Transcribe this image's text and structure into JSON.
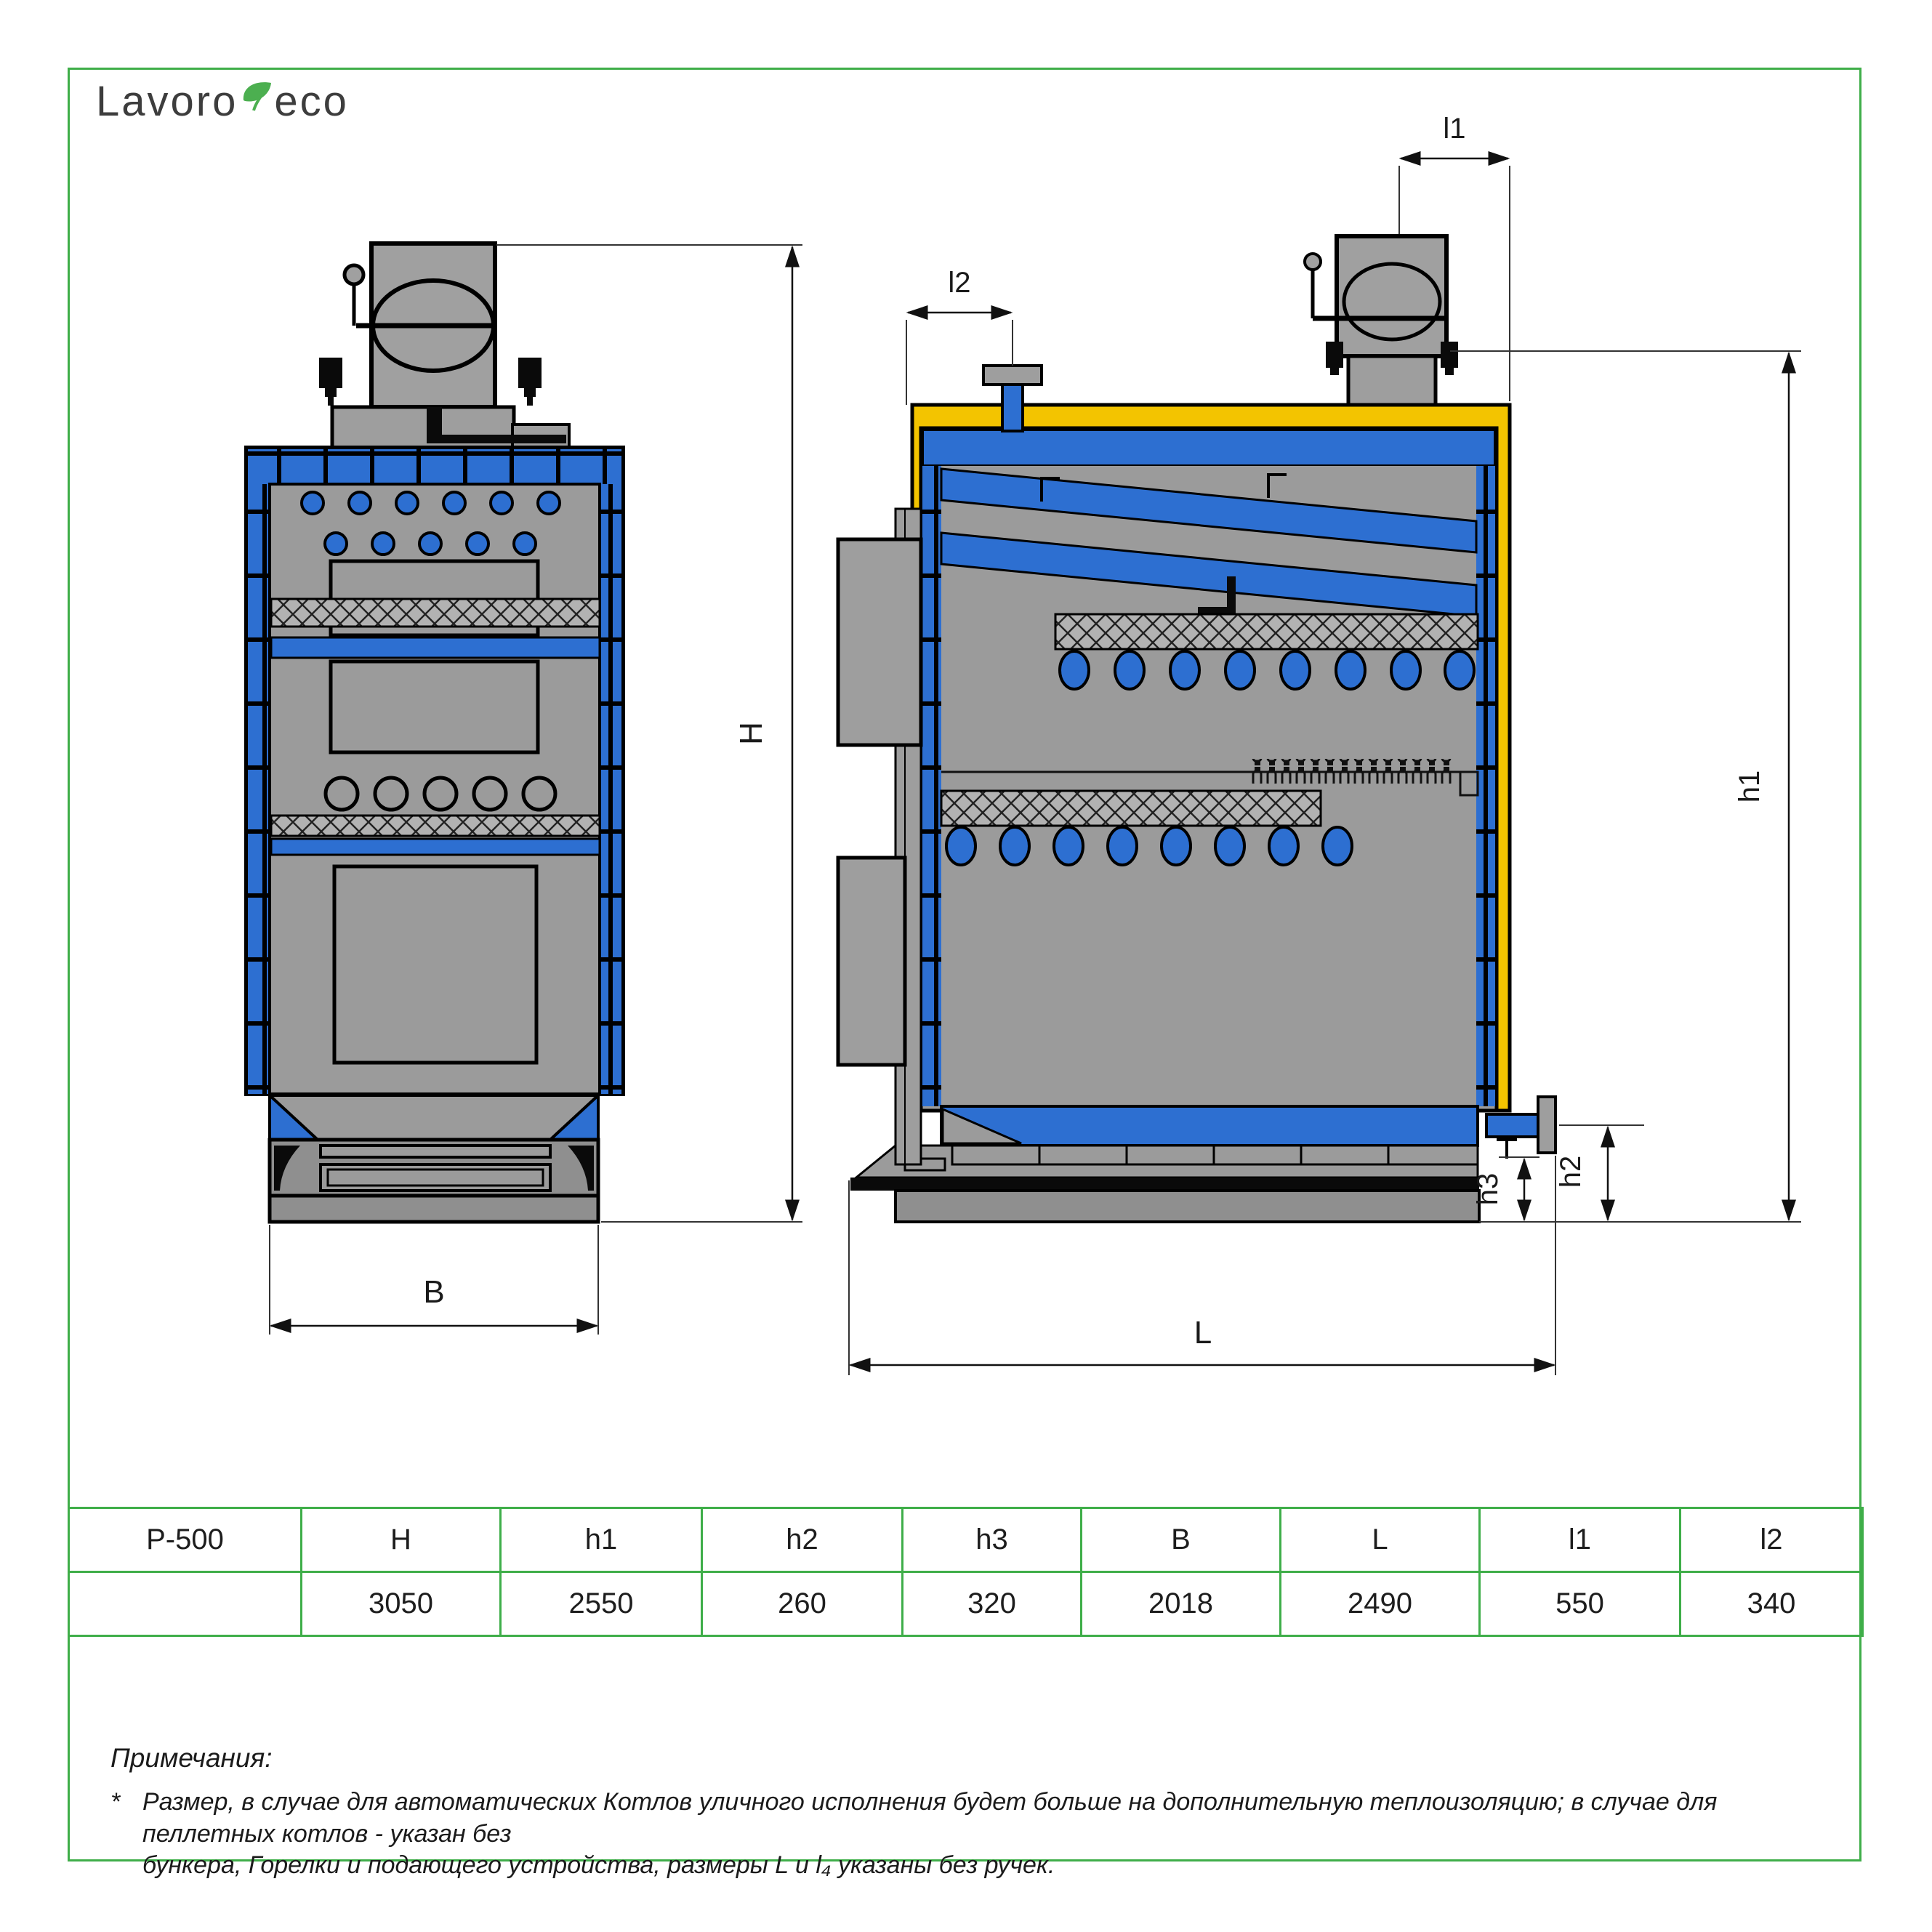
{
  "logo": {
    "part1": "Lavoro",
    "part2": "eco"
  },
  "dims": {
    "H": "H",
    "h1": "h1",
    "h2": "h2",
    "h3": "h3",
    "B": "B",
    "L": "L",
    "l1": "l1",
    "l2": "l2"
  },
  "table": {
    "headers": [
      "P-500",
      "H",
      "h1",
      "h2",
      "h3",
      "B",
      "L",
      "l1",
      "l2"
    ],
    "values": [
      "",
      "3050",
      "2550",
      "260",
      "320",
      "2018",
      "2490",
      "550",
      "340"
    ]
  },
  "notes": {
    "title": "Примечания:",
    "marker": "*",
    "lines": [
      "Размер, в случае для автоматических Котлов уличного исполнения будет больше на дополнительную теплоизоляцию; в случае для пеллетных котлов - указан без",
      "бункера, Горелки и подающего устройства, размеры L и l₄ указаны без ручек."
    ]
  },
  "colors": {
    "accent_blue": "#2d6fd1",
    "insulation_yellow": "#f3c400",
    "frame_green": "#3fae49",
    "body_gray": "#9b9b9b",
    "hatch_gray": "#b2b2b2"
  }
}
